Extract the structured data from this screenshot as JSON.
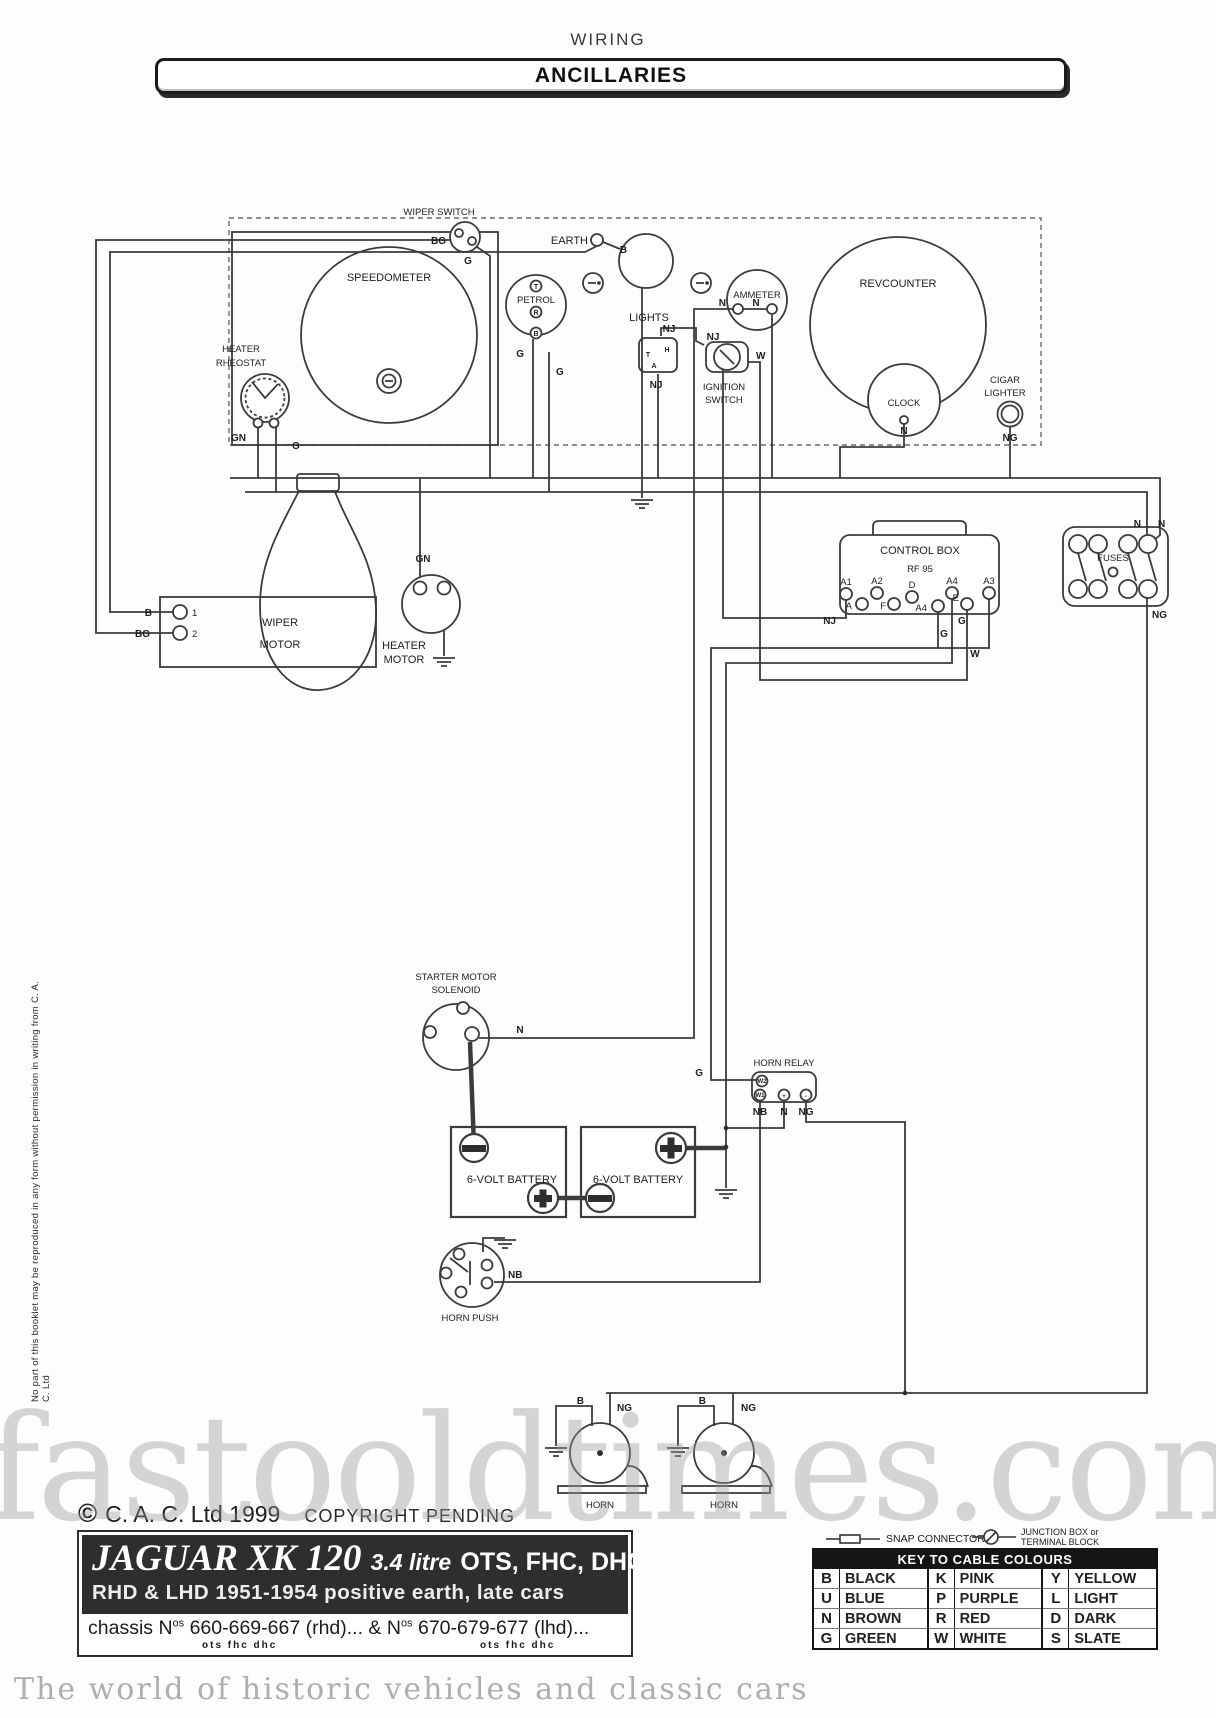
{
  "page": {
    "title": "WIRING",
    "banner": "ANCILLARIES"
  },
  "labels": {
    "speedometer": "SPEEDOMETER",
    "wiper_switch": "WIPER SWITCH",
    "heater": "HEATER",
    "rheostat": "RHEOSTAT",
    "earth": "EARTH",
    "petrol": "PETROL",
    "lights": "LIGHTS",
    "ammeter": "AMMETER",
    "ignition_1": "IGNITION",
    "ignition_2": "SWITCH",
    "rev_counter": "REVCOUNTER",
    "clock": "CLOCK",
    "cigar_1": "CIGAR",
    "cigar_2": "LIGHTER",
    "wiper_motor_1": "WIPER",
    "wiper_motor_2": "MOTOR",
    "heater_motor_1": "HEATER",
    "heater_motor_2": "MOTOR",
    "control_box": "CONTROL BOX",
    "control_box_model": "RF 95",
    "fuses": "FUSES",
    "solenoid_1": "STARTER MOTOR",
    "solenoid_2": "SOLENOID",
    "battery": "6-VOLT BATTERY",
    "horn_relay": "HORN RELAY",
    "horn_push": "HORN PUSH",
    "horn": "HORN"
  },
  "wire": {
    "b": "B",
    "bg": "BG",
    "g": "G",
    "gn": "GN",
    "n": "N",
    "nj": "NJ",
    "ng": "NG",
    "nb": "NB",
    "w": "W"
  },
  "term": {
    "t": "T",
    "r": "R",
    "b": "B",
    "a": "A",
    "h": "H",
    "f": "F",
    "d": "D",
    "e": "E",
    "a1": "A1",
    "a2": "A2",
    "a3": "A3",
    "a4": "A4",
    "w1": "W1",
    "w2": "W2",
    "plus": "+",
    "minus": "-",
    "one": "1",
    "two": "2"
  },
  "footer": {
    "copyright_symbol": "©",
    "copyright": "C. A. C. Ltd 1999",
    "pending": "COPYRIGHT PENDING",
    "model_title": "JAGUAR  XK 120",
    "model_engine": "3.4 litre",
    "model_body": "OTS, FHC, DHC",
    "model_line2": "RHD & LHD 1951-1954 positive earth, late cars",
    "chassis_prefix": "chassis N",
    "chassis_sup1": "os",
    "chassis_mid": " 660-669-667 (rhd)...   &   N",
    "chassis_sup2": "os",
    "chassis_end": " 670-679-677 (lhd)...",
    "chassis_sub": "ots  fhc  dhc"
  },
  "legend": {
    "snap": "SNAP CONNECTOR",
    "junction_1": "JUNCTION BOX or",
    "junction_2": "TERMINAL BLOCK",
    "key_title": "KEY TO CABLE COLOURS",
    "columns": [
      [
        {
          "code": "B",
          "name": "BLACK"
        },
        {
          "code": "U",
          "name": "BLUE"
        },
        {
          "code": "N",
          "name": "BROWN"
        },
        {
          "code": "G",
          "name": "GREEN"
        }
      ],
      [
        {
          "code": "K",
          "name": "PINK"
        },
        {
          "code": "P",
          "name": "PURPLE"
        },
        {
          "code": "R",
          "name": "RED"
        },
        {
          "code": "W",
          "name": "WHITE"
        }
      ],
      [
        {
          "code": "Y",
          "name": "YELLOW"
        },
        {
          "code": "L",
          "name": "LIGHT"
        },
        {
          "code": "D",
          "name": "DARK"
        },
        {
          "code": "S",
          "name": "SLATE"
        }
      ]
    ]
  },
  "side_note": "No part of this booklet may be reproduced in any form without permission in writing from C. A. C. Ltd",
  "watermark": {
    "main": "fastooldtimes.com",
    "tagline": "The world of historic vehicles and classic cars"
  },
  "colors": {
    "ink": "#3b3b3b",
    "block_bg": "#2e2e2e",
    "banner_border": "#1b1b1b"
  }
}
